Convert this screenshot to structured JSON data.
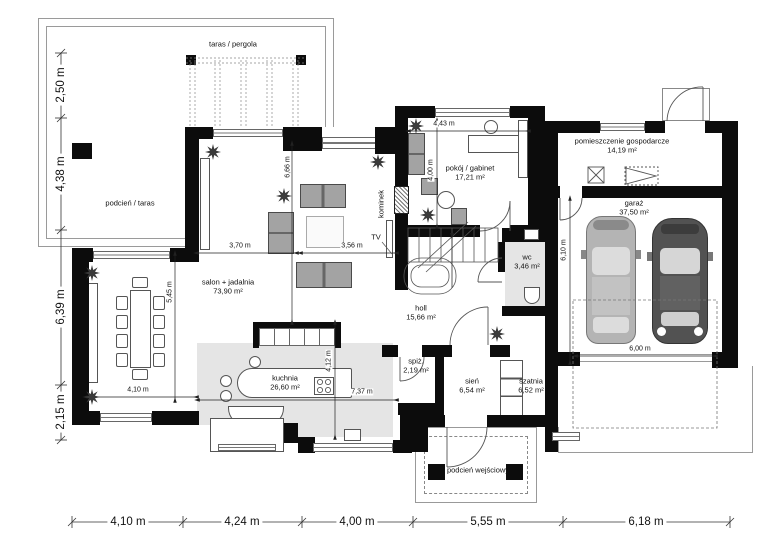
{
  "rooms": [
    {
      "label": "taras / pergola",
      "area": ""
    },
    {
      "label": "podcień / taras",
      "area": ""
    },
    {
      "label": "salon + jadalnia",
      "area": "73,90 m²"
    },
    {
      "label": "kuchnia",
      "area": "26,60 m²"
    },
    {
      "label": "pokój / gabinet",
      "area": "17,21 m²"
    },
    {
      "label": "pomieszczenie gospodarcze",
      "area": "14,19 m²"
    },
    {
      "label": "garaż",
      "area": "37,50 m²"
    },
    {
      "label": "wc",
      "area": "3,46 m²"
    },
    {
      "label": "holl",
      "area": "15,66 m²"
    },
    {
      "label": "spiż.",
      "area": "2,19 m²"
    },
    {
      "label": "sień",
      "area": "6,54 m²"
    },
    {
      "label": "szatnia",
      "area": "6,52 m²"
    },
    {
      "label": "podcień wejściowy",
      "area": ""
    }
  ],
  "fixtures": {
    "kominek": "kominek",
    "tv": "TV"
  },
  "dims": {
    "left": [
      "2,50 m",
      "4,38 m",
      "6,39 m",
      "2,15 m"
    ],
    "bottom": [
      "4,10 m",
      "4,24 m",
      "4,00 m",
      "5,55 m",
      "6,18 m"
    ],
    "interior": [
      "4,43 m",
      "4,00 m",
      "6,66 m",
      "3,70 m",
      "3,56 m",
      "5,45 m",
      "4,10 m",
      "4,12 m",
      "7,37 m",
      "6,10 m",
      "6,00 m"
    ]
  },
  "colors": {
    "wall": "#0c0c0c",
    "floor_gray": "#e5e5e5",
    "car_light": "#b4b4b4",
    "car_dark": "#525252"
  }
}
